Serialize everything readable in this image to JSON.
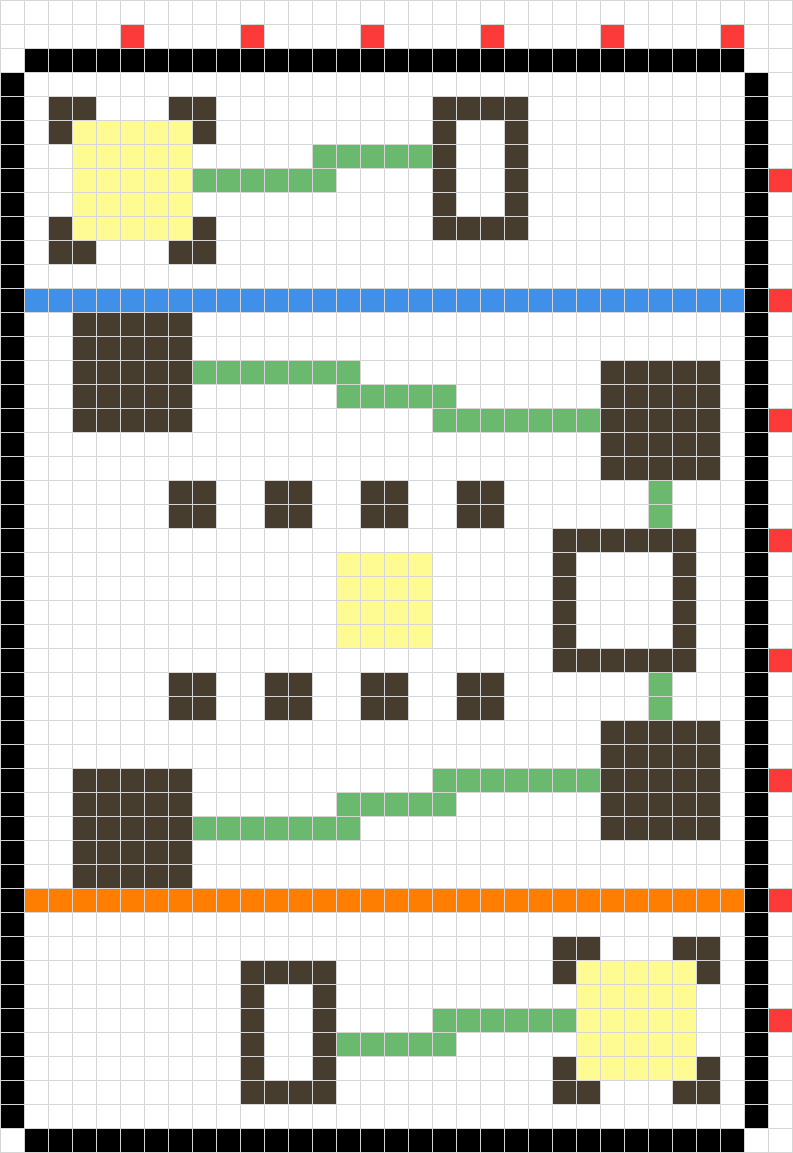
{
  "board": {
    "cols": 33,
    "rows": 48,
    "cell_size_px": 23,
    "grid_line_px": 1,
    "colors": {
      "background": "#ffffff",
      "grid_line": "#d6d6d6",
      "empty": "#ffffff",
      "wall": "#000000",
      "brown_block": "#473d2f",
      "yellow_block": "#fdfb91",
      "green_path": "#6bb96e",
      "red_marker": "#fd3a3a",
      "blue_line": "#4190e8",
      "orange_line": "#fd7e00"
    },
    "legend": {
      ".": "empty",
      "K": "wall",
      "B": "brown_block",
      "Y": "yellow_block",
      "G": "green_path",
      "R": "red_marker",
      "U": "blue_line",
      "O": "orange_line"
    },
    "cells": [
      ".................................",
      ".....R....R....R....R....R....R..",
      ".KKKKKKKKKKKKKKKKKKKKKKKKKKKKKK..",
      "K..............................K.",
      "K.BB...BB.........BBBB.........K.",
      "K.BYYYYYB.........B..B.........K.",
      "K..YYYYY.....GGGGGB..B.........K.",
      "K..YYYYYGGGGGG....B..B.........KR",
      "K..YYYYY..........B..B.........K.",
      "K.BYYYYYB.........BBBB.........K.",
      "K.BB...BB......................K.",
      "K..............................K.",
      "KUUUUUUUUUUUUUUUUUUUUUUUUUUUUUUKR",
      "K..BBBBB.......................K.",
      "K..BBBBB.......................K.",
      "K..BBBBBGGGGGGG..........BBBBB.K.",
      "K..BBBBB......GGGGG......BBBBB.K.",
      "K..BBBBB..........GGGGGGGBBBBB.KR",
      "K........................BBBBB.K.",
      "K........................BBBBB.K.",
      "K......BB..BB..BB..BB......G...K.",
      "K......BB..BB..BB..BB......G...K.",
      "K......................BBBBBB..KR",
      "K.............YYYY.....B....B..K.",
      "K.............YYYY.....B....B..K.",
      "K.............YYYY.....B....B..K.",
      "K.............YYYY.....B....B..K.",
      "K......................BBBBBB..KR",
      "K......BB..BB..BB..BB......G...K.",
      "K......BB..BB..BB..BB......G...K.",
      "K........................BBBBB.K.",
      "K........................BBBBB.K.",
      "K..BBBBB..........GGGGGGGBBBBB.KR",
      "K..BBBBB......GGGGG......BBBBB.K.",
      "K..BBBBBGGGGGGG..........BBBBB.K.",
      "K..BBBBB.......................K.",
      "K..BBBBB.......................K.",
      "KOOOOOOOOOOOOOOOOOOOOOOOOOOOOOOKR",
      "K..............................K.",
      "K......................BB...BB.K.",
      "K.........BBBB.........BYYYYYB.K.",
      "K.........B..B..........YYYYY..K.",
      "K.........B..B....GGGGGGYYYYY..KR",
      "K.........B..BGGGGG.....YYYYY..K.",
      "K.........B..B.........BYYYYYB.K.",
      "K.........BBBB.........BB...BB.K.",
      "K..............................K.",
      ".KKKKKKKKKKKKKKKKKKKKKKKKKKKKKK.."
    ]
  }
}
